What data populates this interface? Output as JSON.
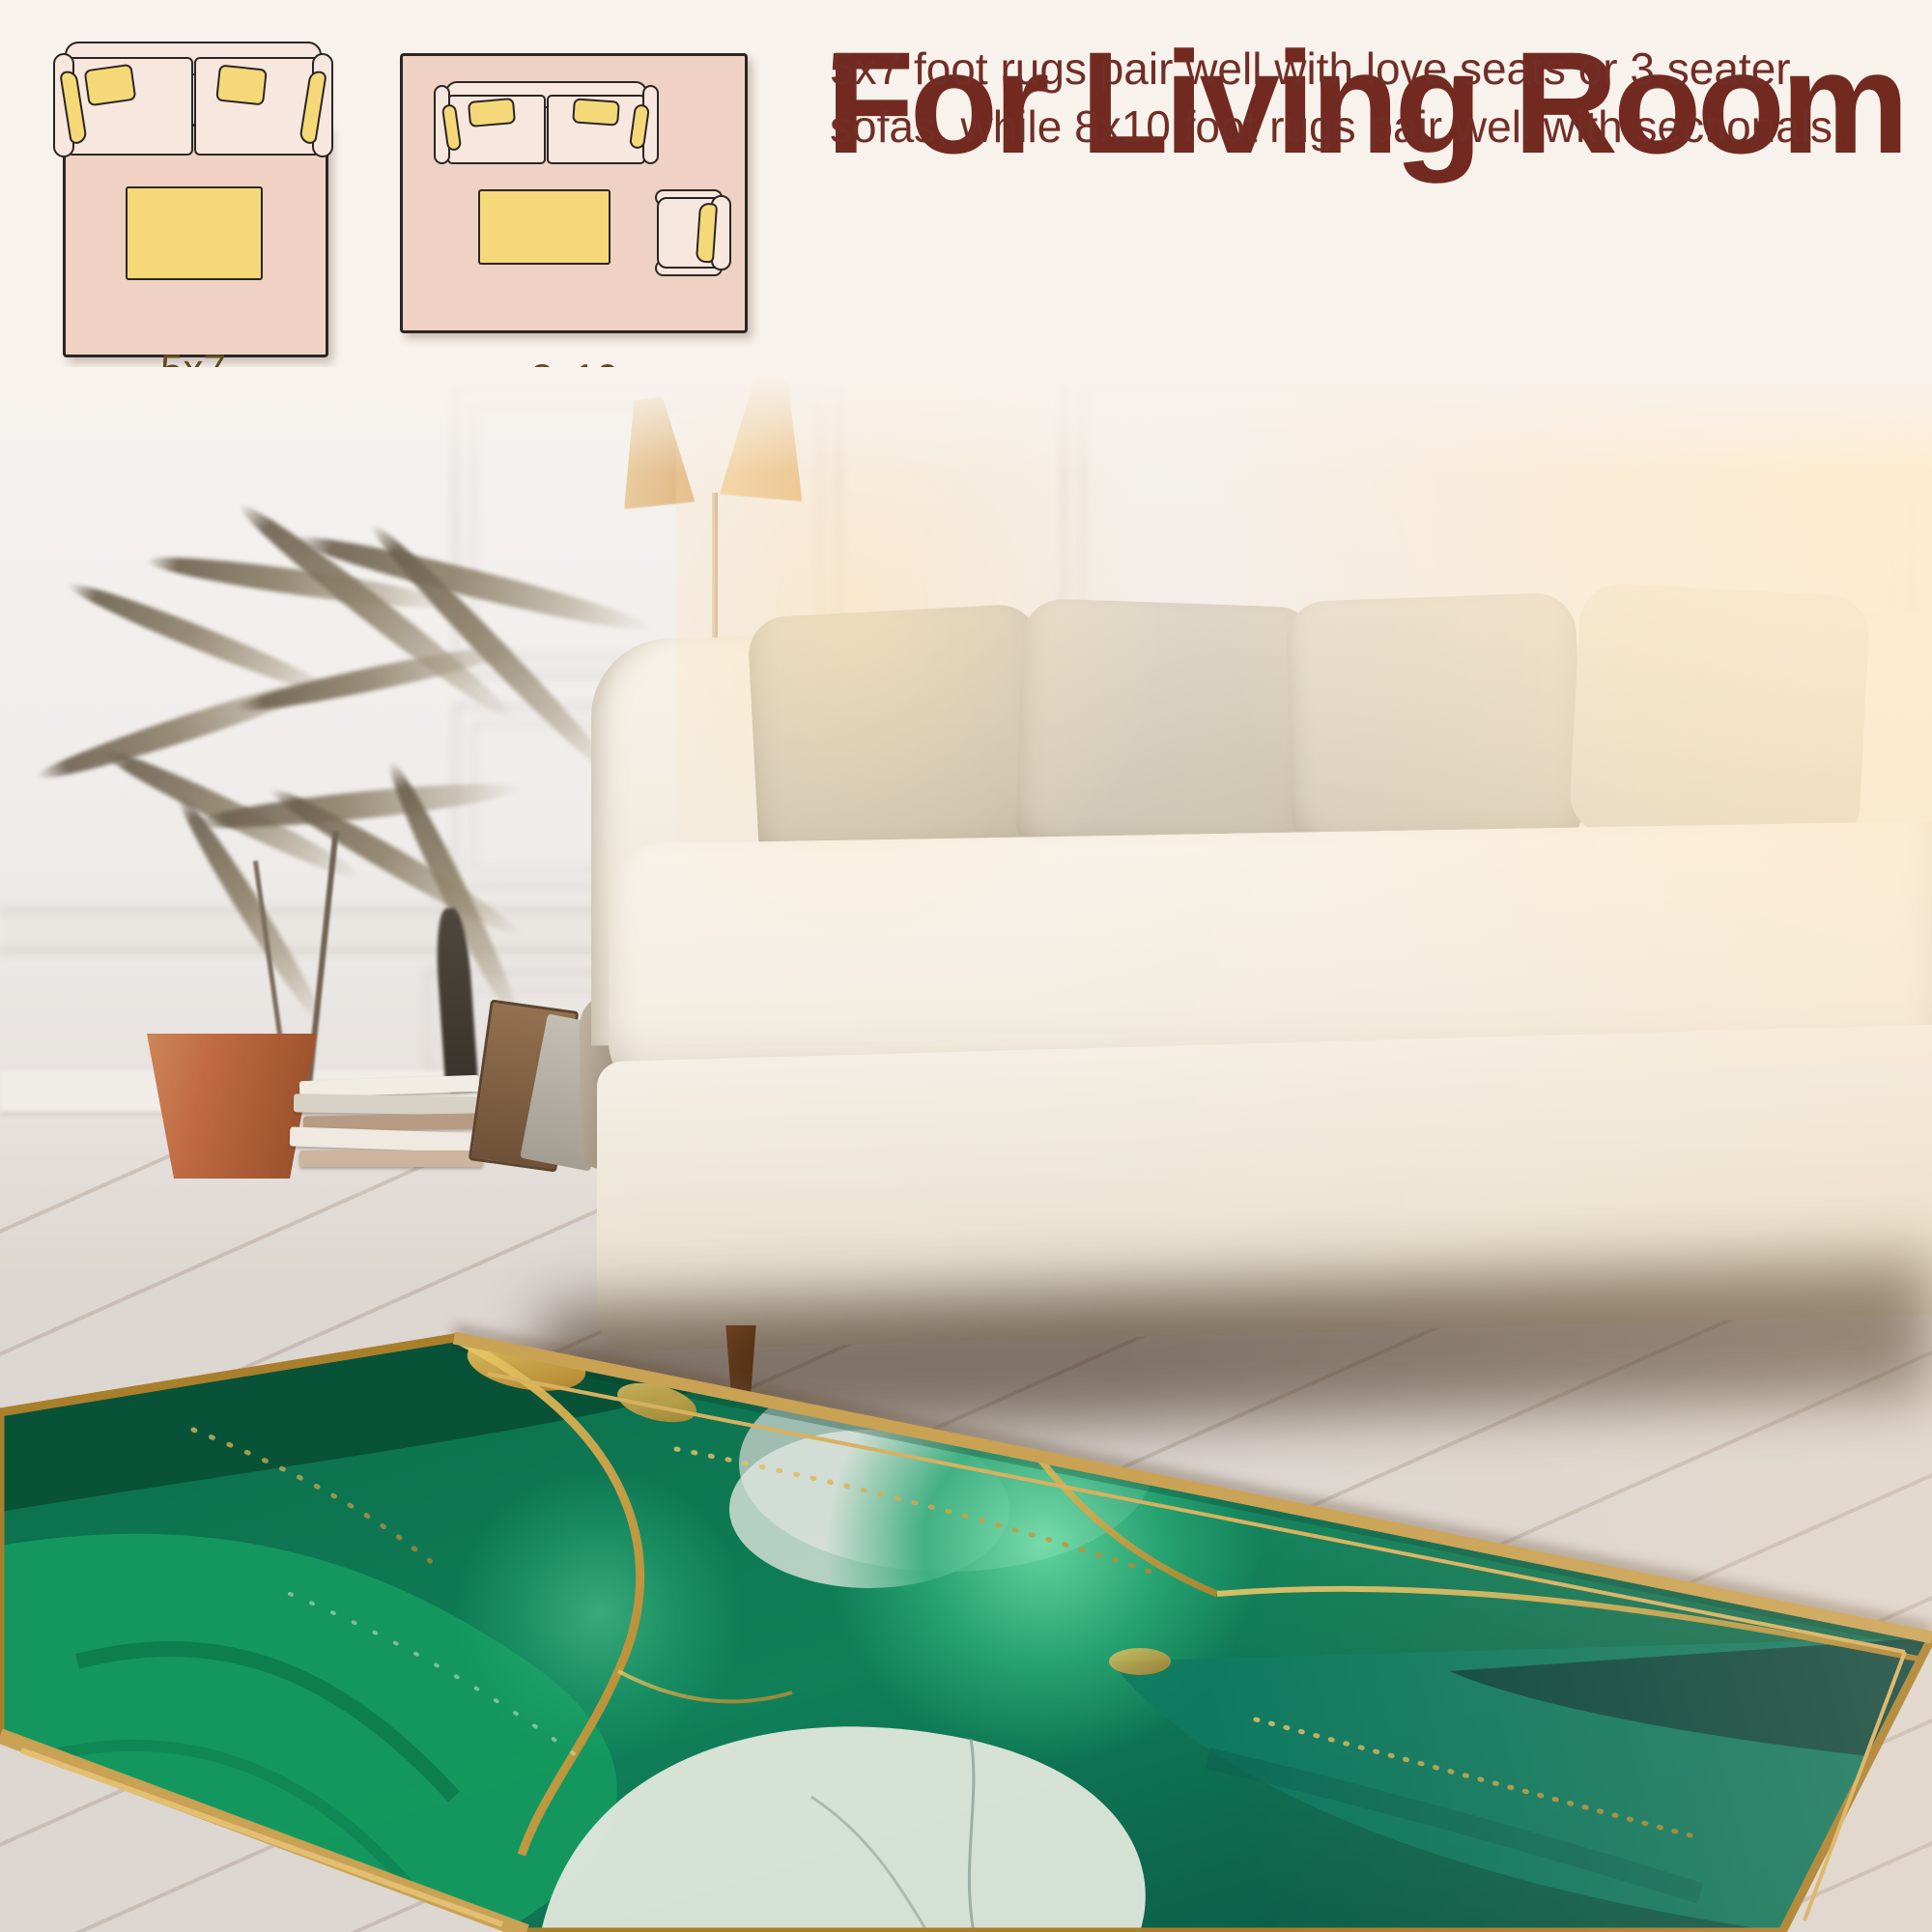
{
  "page": {
    "background_color": "#f8f2ec"
  },
  "header": {
    "title": "For Living Room",
    "title_color": "#722a20",
    "description_lines": [
      "5x7 foot rugs pair well with love seats or 3 seater",
      "sofas, while 8x10 foot rugs pair well with sectionals."
    ]
  },
  "size_guide": {
    "label_color": "#5e4a26",
    "items": [
      {
        "label": "5x7",
        "icon": "loveseat-and-coffee-table-on-rug-top-view-icon"
      },
      {
        "label": "8x10",
        "icon": "sofa-coffee-table-and-armchair-on-rug-top-view-icon"
      }
    ],
    "diagram_colors": {
      "rug_fill": "#efd2c3",
      "furniture_fill": "#f8e7de",
      "accent_yellow": "#f5d978",
      "outline": "#2a2623"
    }
  },
  "photo": {
    "rug_colors": {
      "emerald": "#0f8059",
      "dark_green": "#084f36",
      "teal": "#0f7a60",
      "mint": "#6fe0a8",
      "pale_marble": "#dde5da",
      "gold": "#c9a254"
    }
  }
}
